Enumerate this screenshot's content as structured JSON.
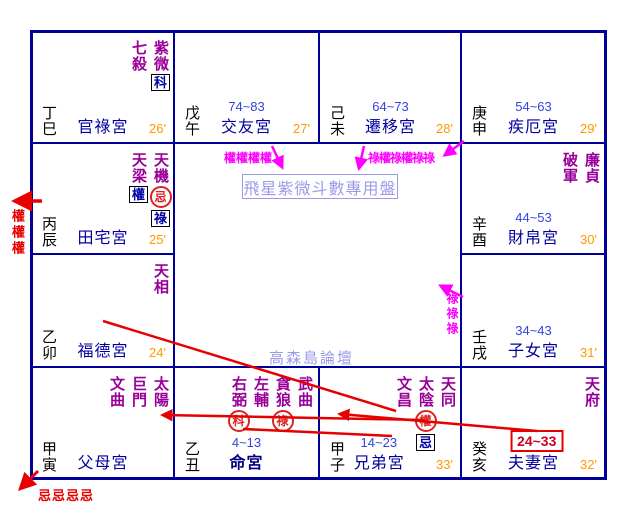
{
  "center": {
    "title": "飛星紫微斗數專用盤",
    "watermark": "高森島論壇"
  },
  "palaces": {
    "si": {
      "branch": "丁巳",
      "name": "官祿宮",
      "minute": "26'",
      "stars": [
        {
          "name": "紫微",
          "markers": [
            {
              "style": "box",
              "char": "科"
            }
          ]
        },
        {
          "name": "七殺"
        }
      ]
    },
    "wu": {
      "branch": "戊午",
      "name": "交友宮",
      "minute": "27'",
      "age": "74~83"
    },
    "wei": {
      "branch": "己未",
      "name": "遷移宮",
      "minute": "28'",
      "age": "64~73"
    },
    "shen": {
      "branch": "庚申",
      "name": "疾厄宮",
      "minute": "29'",
      "age": "54~63"
    },
    "chen": {
      "branch": "丙辰",
      "name": "田宅宮",
      "minute": "25'",
      "stars": [
        {
          "name": "天機",
          "markers": [
            {
              "style": "circle",
              "char": "忌"
            },
            {
              "style": "box",
              "char": "祿"
            }
          ]
        },
        {
          "name": "天梁",
          "markers": [
            {
              "style": "box",
              "char": "權"
            }
          ]
        }
      ]
    },
    "you": {
      "branch": "辛酉",
      "name": "財帛宮",
      "minute": "30'",
      "age": "44~53",
      "stars": [
        {
          "name": "廉貞"
        },
        {
          "name": "破軍"
        }
      ]
    },
    "mao": {
      "branch": "乙卯",
      "name": "福德宮",
      "minute": "24'",
      "stars": [
        {
          "name": "天相"
        }
      ]
    },
    "xu": {
      "branch": "壬戌",
      "name": "子女宮",
      "minute": "31'",
      "age": "34~43"
    },
    "yin": {
      "branch": "甲寅",
      "name": "父母宮",
      "stars": [
        {
          "name": "太陽"
        },
        {
          "name": "巨門"
        },
        {
          "name": "文曲"
        }
      ]
    },
    "chou": {
      "branch": "乙丑",
      "name": "命宮",
      "age": "4~13",
      "stars": [
        {
          "name": "武曲"
        },
        {
          "name": "貪狼",
          "markers": [
            {
              "style": "circle",
              "char": "祿"
            }
          ]
        },
        {
          "name": "左輔"
        },
        {
          "name": "右弼",
          "markers": [
            {
              "style": "circle",
              "char": "科"
            }
          ]
        }
      ]
    },
    "zi": {
      "branch": "甲子",
      "name": "兄弟宮",
      "minute": "33'",
      "age": "14~23",
      "stars": [
        {
          "name": "天同"
        },
        {
          "name": "太陰",
          "markers": [
            {
              "style": "circle",
              "char": "權"
            },
            {
              "style": "box",
              "char": "忌"
            }
          ]
        },
        {
          "name": "文昌"
        }
      ]
    },
    "hai": {
      "branch": "癸亥",
      "name": "夫妻宮",
      "minute": "32'",
      "decade": "24~33",
      "stars": [
        {
          "name": "天府"
        }
      ]
    }
  },
  "annotations": {
    "quan_left_vertical": "權權權",
    "ji_bottom_left": "忌忌忌忌",
    "quan_top_center": "權權權權",
    "lu_quan_top_right": "祿權祿權祿祿",
    "lu_right_vertical": "祿祿祿"
  },
  "colors": {
    "grid": "#000099",
    "palace_name": "#0000a0",
    "star": "#990099",
    "age_range": "#3344dd",
    "minute": "#ff9900",
    "arrow_red": "#e80000",
    "arrow_magenta": "#ff00ff",
    "watermark": "#9a9ae8",
    "marker_blue": "#0000aa",
    "decade_text": "#cc0022"
  }
}
